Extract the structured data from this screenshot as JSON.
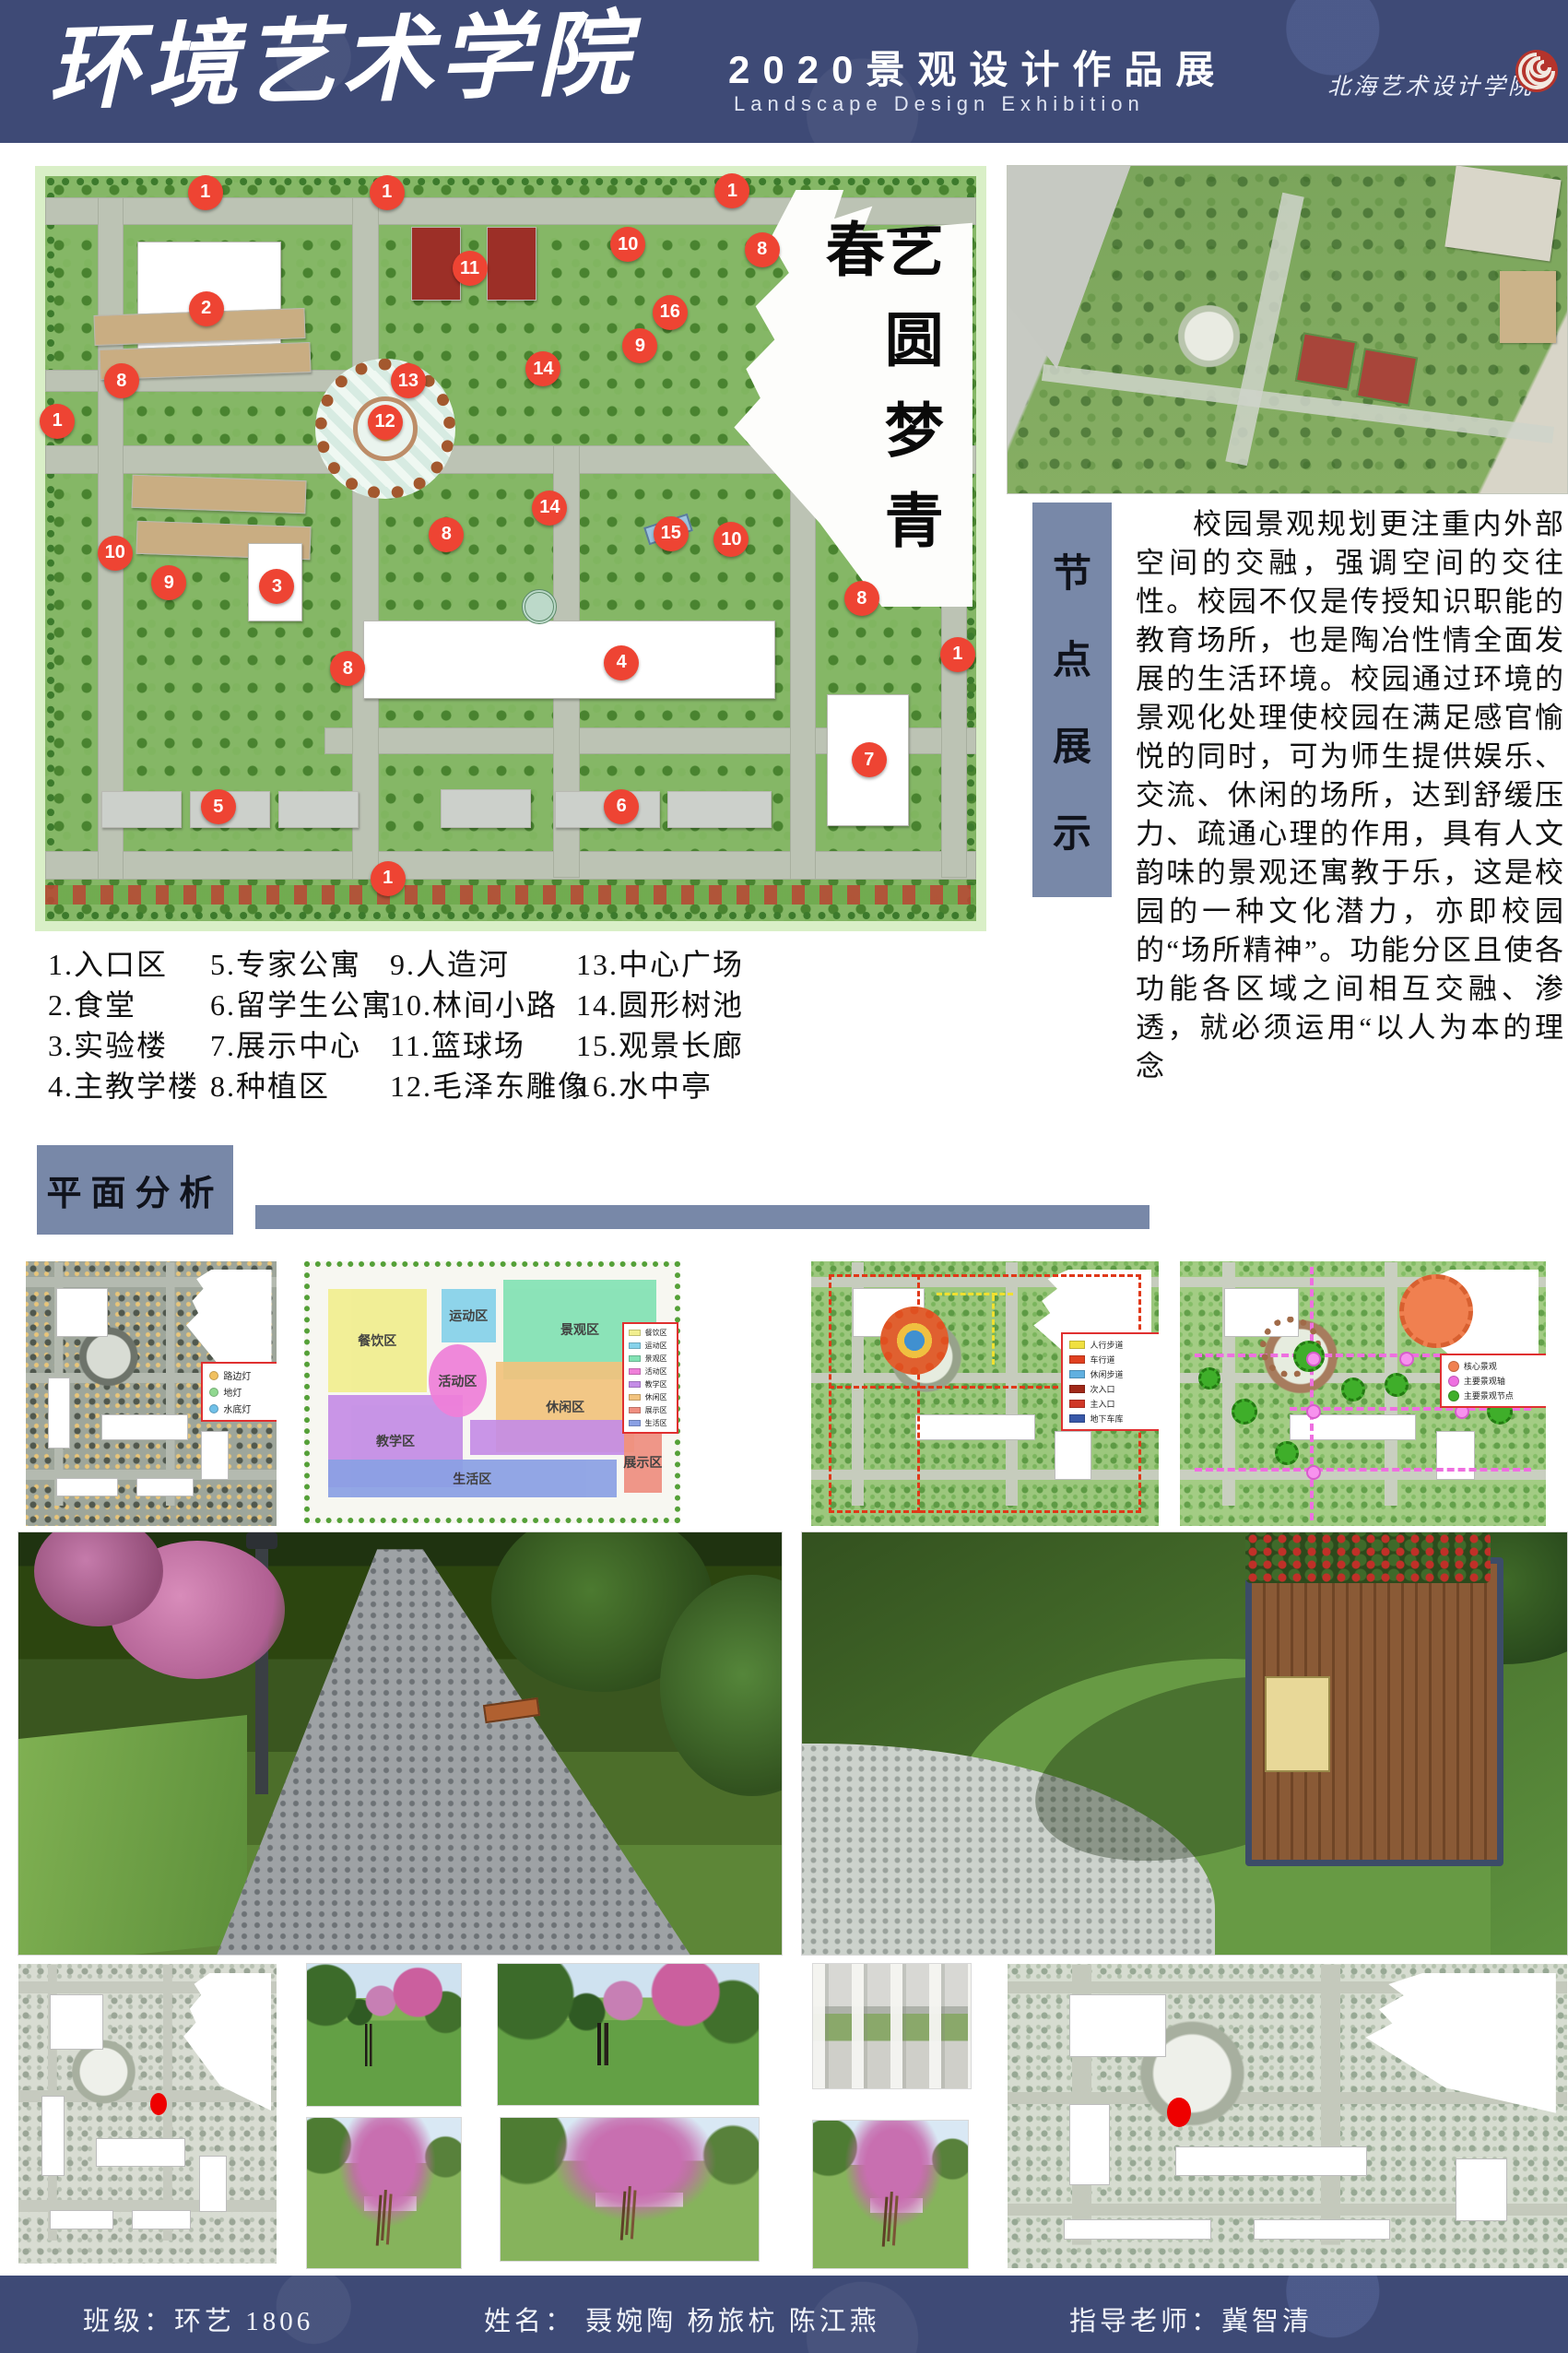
{
  "header": {
    "title": "环境艺术学院",
    "subtitle_cn": "2020景观设计作品展",
    "subtitle_en": "Landscape Design Exhibition",
    "logo_text": "北海艺术设计学院"
  },
  "colors": {
    "band_blue": "#3e4a76",
    "panel_blue": "#7888a8",
    "marker_red": "#ee4433"
  },
  "master_plan": {
    "motto_vertical": "艺圆梦青春",
    "markers": [
      {
        "n": "1",
        "x": "17.2%",
        "y": "2.2%"
      },
      {
        "n": "1",
        "x": "36.7%",
        "y": "2.2%"
      },
      {
        "n": "1",
        "x": "73.8%",
        "y": "2.0%"
      },
      {
        "n": "1",
        "x": "1.3%",
        "y": "32.9%"
      },
      {
        "n": "1",
        "x": "98.0%",
        "y": "64.2%"
      },
      {
        "n": "1",
        "x": "36.8%",
        "y": "94.3%"
      },
      {
        "n": "2",
        "x": "17.3%",
        "y": "17.8%"
      },
      {
        "n": "3",
        "x": "24.9%",
        "y": "55.1%"
      },
      {
        "n": "4",
        "x": "61.9%",
        "y": "65.3%"
      },
      {
        "n": "5",
        "x": "18.6%",
        "y": "84.7%"
      },
      {
        "n": "6",
        "x": "61.9%",
        "y": "84.6%"
      },
      {
        "n": "7",
        "x": "88.5%",
        "y": "78.4%"
      },
      {
        "n": "8",
        "x": "8.2%",
        "y": "27.5%"
      },
      {
        "n": "8",
        "x": "43.1%",
        "y": "48.1%"
      },
      {
        "n": "8",
        "x": "32.5%",
        "y": "66.1%"
      },
      {
        "n": "8",
        "x": "77.0%",
        "y": "9.9%"
      },
      {
        "n": "8",
        "x": "87.7%",
        "y": "56.7%"
      },
      {
        "n": "9",
        "x": "63.9%",
        "y": "22.8%"
      },
      {
        "n": "9",
        "x": "13.3%",
        "y": "54.6%"
      },
      {
        "n": "10",
        "x": "62.6%",
        "y": "9.2%"
      },
      {
        "n": "10",
        "x": "7.5%",
        "y": "50.6%"
      },
      {
        "n": "10",
        "x": "73.7%",
        "y": "48.8%"
      },
      {
        "n": "11",
        "x": "45.6%",
        "y": "12.4%"
      },
      {
        "n": "12",
        "x": "36.5%",
        "y": "33.0%"
      },
      {
        "n": "13",
        "x": "39.0%",
        "y": "27.5%"
      },
      {
        "n": "14",
        "x": "53.5%",
        "y": "25.9%"
      },
      {
        "n": "14",
        "x": "54.2%",
        "y": "44.5%"
      },
      {
        "n": "15",
        "x": "67.2%",
        "y": "48.0%"
      },
      {
        "n": "16",
        "x": "67.1%",
        "y": "18.3%"
      }
    ],
    "buildings": [
      {
        "l": "9.9%",
        "t": "8.8%",
        "w": "15.2%",
        "h": "17.0%",
        "bg": "#ffffff"
      },
      {
        "l": "39.3%",
        "t": "6.8%",
        "w": "5.2%",
        "h": "9.6%",
        "bg": "#9c2f27"
      },
      {
        "l": "47.4%",
        "t": "6.8%",
        "w": "5.2%",
        "h": "9.6%",
        "bg": "#9c2f27"
      },
      {
        "l": "5.2%",
        "t": "18.2%",
        "w": "22.5%",
        "h": "3.8%",
        "bg": "#c9ad82",
        "rot": "rotate(-2deg)"
      },
      {
        "l": "5.8%",
        "t": "22.8%",
        "w": "22.5%",
        "h": "3.8%",
        "bg": "#c9ad82",
        "rot": "rotate(-2deg)"
      },
      {
        "l": "9.3%",
        "t": "40.5%",
        "w": "18.5%",
        "h": "4.2%",
        "bg": "#c9ad82",
        "rot": "rotate(2deg)"
      },
      {
        "l": "9.8%",
        "t": "46.6%",
        "w": "18.5%",
        "h": "4.2%",
        "bg": "#c9ad82",
        "rot": "rotate(2deg)"
      },
      {
        "l": "21.8%",
        "t": "49.2%",
        "w": "5.6%",
        "h": "10.3%",
        "bg": "#ffffff"
      },
      {
        "l": "34.2%",
        "t": "59.7%",
        "w": "44.0%",
        "h": "10.2%",
        "bg": "#ffffff"
      },
      {
        "l": "84.0%",
        "t": "69.5%",
        "w": "8.6%",
        "h": "17.5%",
        "bg": "#ffffff"
      },
      {
        "l": "6.0%",
        "t": "82.6%",
        "w": "8.5%",
        "h": "4.6%",
        "bg": "#ccd0cb"
      },
      {
        "l": "15.5%",
        "t": "82.6%",
        "w": "8.5%",
        "h": "4.6%",
        "bg": "#ccd0cb"
      },
      {
        "l": "25.0%",
        "t": "82.6%",
        "w": "8.5%",
        "h": "4.6%",
        "bg": "#ccd0cb"
      },
      {
        "l": "42.5%",
        "t": "82.3%",
        "w": "9.5%",
        "h": "4.9%",
        "bg": "#ccd0cb"
      },
      {
        "l": "54.8%",
        "t": "82.6%",
        "w": "11.0%",
        "h": "4.6%",
        "bg": "#ccd0cb"
      },
      {
        "l": "66.8%",
        "t": "82.6%",
        "w": "11.0%",
        "h": "4.6%",
        "bg": "#ccd0cb"
      }
    ]
  },
  "node_panel": {
    "label_chars": [
      "节",
      "点",
      "展",
      "示"
    ]
  },
  "intro": {
    "text": "校园景观规划更注重内外部空间的交融，强调空间的交往性。校园不仅是传授知识职能的教育场所，也是陶冶性情全面发展的生活环境。校园通过环境的景观化处理使校园在满足感官愉悦的同时，可为师生提供娱乐、交流、休闲的场所，达到舒缓压力、疏通心理的作用，具有人文韵味的景观还寓教于乐，这是校园的一种文化潜力，亦即校园的“场所精神”。功能分区且使各功能各区域之间相互交融、渗透，就必须运用“以人为本的理念"
  },
  "legend": {
    "col1": [
      "1.入口区",
      "2.食堂",
      "3.实验楼",
      "4.主教学楼"
    ],
    "col2": [
      "5.专家公寓",
      "6.留学生公寓",
      "7.展示中心",
      "8.种植区"
    ],
    "col3": [
      "9.人造河",
      "10.林间小路",
      "11.篮球场",
      "12.毛泽东雕像"
    ],
    "col4": [
      "13.中心广场",
      "14.圆形树池",
      "15.观景长廊",
      "16.水中亭"
    ]
  },
  "plan_analysis": {
    "label": "平面分析",
    "lighting_legend": [
      {
        "label": "路边灯",
        "c": "#f0c060"
      },
      {
        "label": "地灯",
        "c": "#90d890"
      },
      {
        "label": "水底灯",
        "c": "#70c0e8"
      }
    ],
    "zones": [
      {
        "label": "餐饮区",
        "bg": "#f1ee8f",
        "l": "5%",
        "t": "9%",
        "w": "27%",
        "h": "41%",
        "br": "0"
      },
      {
        "label": "运动区",
        "bg": "#86d2ea",
        "l": "36%",
        "t": "9%",
        "w": "15%",
        "h": "21%",
        "br": "0"
      },
      {
        "label": "景观区",
        "bg": "#82e2b4",
        "l": "53%",
        "t": "5%",
        "w": "42%",
        "h": "40%",
        "br": "0"
      },
      {
        "label": "休闲区",
        "bg": "#f2c37e",
        "l": "51%",
        "t": "38%",
        "w": "38%",
        "h": "36%",
        "br": "0"
      },
      {
        "label": "教学区",
        "bg": "#c48ce6",
        "l": "5%",
        "t": "51%",
        "w": "37%",
        "h": "37%",
        "br": "0"
      },
      {
        "label": "",
        "bg": "#c48ce6",
        "l": "44%",
        "t": "61%",
        "w": "42%",
        "h": "14%",
        "br": "0"
      },
      {
        "label": "生活区",
        "bg": "#8aa0e4",
        "l": "5%",
        "t": "77%",
        "w": "79%",
        "h": "15%",
        "br": "0"
      },
      {
        "label": "展示区",
        "bg": "#ef8e80",
        "l": "86%",
        "t": "66%",
        "w": "10.5%",
        "h": "24%",
        "br": "0"
      },
      {
        "label": "活动区",
        "bg": "#ef7fd9",
        "l": "32.5%",
        "t": "31%",
        "w": "16%",
        "h": "29%",
        "br": "50%"
      }
    ],
    "zone_legend": [
      {
        "label": "餐饮区",
        "c": "#f1ee8f"
      },
      {
        "label": "运动区",
        "c": "#86d2ea"
      },
      {
        "label": "景观区",
        "c": "#82e2b4"
      },
      {
        "label": "活动区",
        "c": "#ef7fd9"
      },
      {
        "label": "教学区",
        "c": "#c48ce6"
      },
      {
        "label": "休闲区",
        "c": "#f2c37e"
      },
      {
        "label": "展示区",
        "c": "#ef8e80"
      },
      {
        "label": "生活区",
        "c": "#8aa0e4"
      }
    ],
    "traffic_legend": [
      {
        "label": "人行步道",
        "c": "#f0e040"
      },
      {
        "label": "车行道",
        "c": "#e04020"
      },
      {
        "label": "休闲步道",
        "c": "#60b0e0"
      },
      {
        "label": "次入口",
        "c": "#a02818"
      },
      {
        "label": "主入口",
        "c": "#d03828"
      },
      {
        "label": "地下车库",
        "c": "#3858a8"
      }
    ],
    "axis_legend": [
      {
        "label": "核心景观",
        "c": "#f08050"
      },
      {
        "label": "主要景观轴",
        "c": "#ee6fe0"
      },
      {
        "label": "主要景观节点",
        "c": "#3fae2a"
      }
    ]
  },
  "footer": {
    "class_label": "班级：环艺 1806",
    "names_label": "姓名：  聂婉陶  杨旅杭  陈江燕",
    "teacher_label": "指导老师：冀智清"
  }
}
